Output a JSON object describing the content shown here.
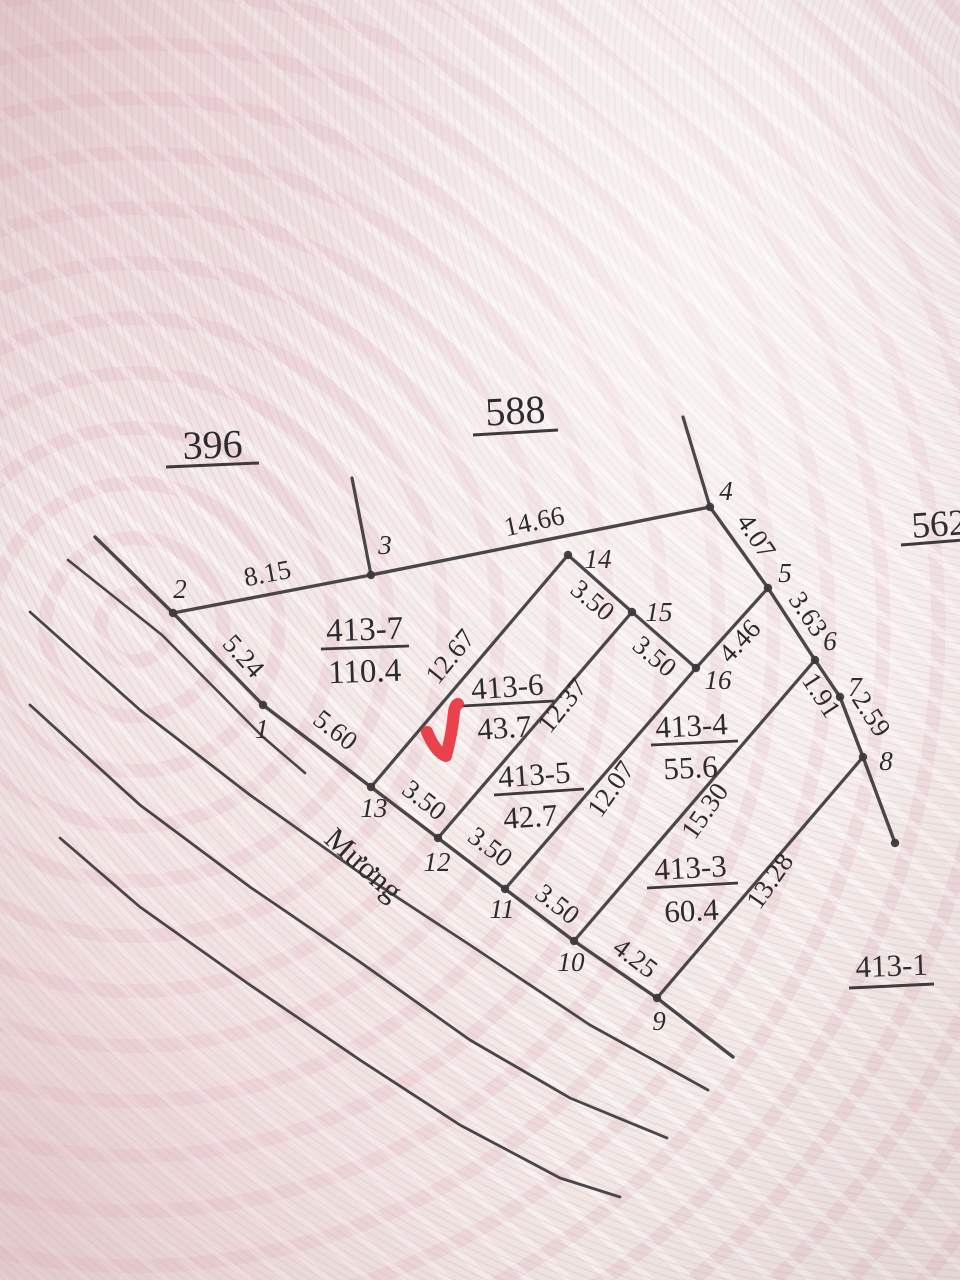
{
  "title": "Cadastral sketch photo - parcel 413 subdivision",
  "ink": "#3d393c",
  "text_color": "#2e2b2f",
  "accent_red": "#e8333e",
  "canal_label": {
    "text": "Mương",
    "x": 357,
    "y": 872,
    "rot": 42,
    "size": 31
  },
  "checkmark": {
    "path": "M 427 732 Q 436 753 446 756 Q 452 734 454 712 Q 455 705 458 704",
    "width": 12
  },
  "lines": [
    {
      "name": "south-boundary-canal-edge",
      "w": 3.4,
      "p": [
        [
          95,
          537
        ],
        [
          173,
          613
        ],
        [
          263,
          705
        ],
        [
          371,
          787
        ],
        [
          438,
          838
        ],
        [
          505,
          889
        ],
        [
          574,
          941
        ],
        [
          657,
          998
        ],
        [
          733,
          1057
        ]
      ]
    },
    {
      "name": "north-boundary",
      "w": 3.4,
      "p": [
        [
          173,
          613
        ],
        [
          371,
          575
        ],
        [
          710,
          507
        ]
      ]
    },
    {
      "name": "point3-extension",
      "w": 3.2,
      "p": [
        [
          352,
          478
        ],
        [
          371,
          575
        ]
      ]
    },
    {
      "name": "point4-extension",
      "w": 3.2,
      "p": [
        [
          683,
          417
        ],
        [
          710,
          507
        ]
      ]
    },
    {
      "name": "east-boundary",
      "w": 3.4,
      "p": [
        [
          710,
          507
        ],
        [
          768,
          588
        ],
        [
          815,
          660
        ],
        [
          840,
          697
        ],
        [
          863,
          757
        ],
        [
          895,
          843
        ]
      ]
    },
    {
      "name": "cross-line-14-15-16-5",
      "w": 3.2,
      "p": [
        [
          568,
          555
        ],
        [
          632,
          612
        ],
        [
          696,
          668
        ],
        [
          768,
          588
        ]
      ]
    },
    {
      "name": "strip-edge-14-13",
      "w": 3.2,
      "p": [
        [
          568,
          555
        ],
        [
          371,
          787
        ]
      ]
    },
    {
      "name": "strip-edge-15-12",
      "w": 3.2,
      "p": [
        [
          632,
          612
        ],
        [
          438,
          838
        ]
      ]
    },
    {
      "name": "strip-edge-16-11",
      "w": 3.2,
      "p": [
        [
          696,
          668
        ],
        [
          505,
          889
        ]
      ]
    },
    {
      "name": "strip-edge-6-10",
      "w": 3.2,
      "p": [
        [
          815,
          660
        ],
        [
          574,
          941
        ]
      ]
    },
    {
      "name": "strip-edge-8-9",
      "w": 3.2,
      "p": [
        [
          863,
          757
        ],
        [
          657,
          998
        ]
      ]
    },
    {
      "name": "parallel-line-short",
      "w": 2.6,
      "p": [
        [
          68,
          560
        ],
        [
          162,
          635
        ],
        [
          263,
          737
        ],
        [
          305,
          773
        ]
      ]
    },
    {
      "name": "canal-line-1",
      "w": 2.8,
      "p": [
        [
          30,
          612
        ],
        [
          140,
          710
        ],
        [
          250,
          795
        ],
        [
          360,
          873
        ],
        [
          470,
          945
        ],
        [
          590,
          1025
        ],
        [
          708,
          1090
        ]
      ]
    },
    {
      "name": "canal-line-2",
      "w": 2.8,
      "p": [
        [
          30,
          705
        ],
        [
          140,
          805
        ],
        [
          250,
          887
        ],
        [
          360,
          962
        ],
        [
          470,
          1040
        ],
        [
          570,
          1098
        ],
        [
          667,
          1138
        ]
      ]
    },
    {
      "name": "canal-line-3",
      "w": 2.8,
      "p": [
        [
          60,
          838
        ],
        [
          140,
          907
        ],
        [
          250,
          985
        ],
        [
          360,
          1060
        ],
        [
          460,
          1125
        ],
        [
          560,
          1178
        ],
        [
          620,
          1197
        ]
      ]
    }
  ],
  "vertices": [
    [
      173,
      613
    ],
    [
      371,
      575
    ],
    [
      710,
      507
    ],
    [
      768,
      588
    ],
    [
      815,
      660
    ],
    [
      840,
      697
    ],
    [
      863,
      757
    ],
    [
      263,
      705
    ],
    [
      371,
      787
    ],
    [
      438,
      838
    ],
    [
      505,
      889
    ],
    [
      574,
      941
    ],
    [
      657,
      998
    ],
    [
      568,
      555
    ],
    [
      632,
      612
    ],
    [
      696,
      668
    ],
    [
      895,
      843
    ]
  ],
  "region_labels": [
    {
      "text": "396",
      "x": 213,
      "y": 458,
      "rot": -2,
      "size": 40,
      "ul": [
        166,
        467,
        259,
        463
      ]
    },
    {
      "text": "588",
      "x": 516,
      "y": 424,
      "rot": -3,
      "size": 40,
      "ul": [
        473,
        435,
        558,
        430
      ]
    },
    {
      "text": "562",
      "x": 940,
      "y": 536,
      "rot": -4,
      "size": 37,
      "ul": [
        901,
        545,
        975,
        539
      ]
    },
    {
      "text": "413-1",
      "x": 892,
      "y": 976,
      "rot": -2,
      "size": 31,
      "ul": [
        849,
        988,
        934,
        984
      ]
    }
  ],
  "parcel_labels": [
    {
      "name": "413-7",
      "area": "110.4",
      "x": 365,
      "y": 640,
      "ax": 365,
      "ay": 682,
      "rot": -2,
      "size": 33,
      "ul": [
        321,
        649,
        409,
        646
      ]
    },
    {
      "name": "413-6",
      "area": "43.7",
      "x": 508,
      "y": 697,
      "ax": 505,
      "ay": 738,
      "rot": -4,
      "size": 31,
      "ul": [
        462,
        706,
        554,
        701
      ]
    },
    {
      "name": "413-5",
      "area": "42.7",
      "x": 535,
      "y": 785,
      "ax": 531,
      "ay": 827,
      "rot": -4,
      "size": 31,
      "ul": [
        494,
        795,
        584,
        789
      ]
    },
    {
      "name": "413-4",
      "area": "55.6",
      "x": 692,
      "y": 736,
      "ax": 691,
      "ay": 778,
      "rot": -3,
      "size": 31,
      "ul": [
        651,
        745,
        738,
        741
      ]
    },
    {
      "name": "413-3",
      "area": "60.4",
      "x": 691,
      "y": 878,
      "ax": 692,
      "ay": 921,
      "rot": -3,
      "size": 31,
      "ul": [
        647,
        888,
        738,
        883
      ]
    }
  ],
  "dim_labels": [
    {
      "text": "8.15",
      "x": 269,
      "y": 582,
      "rot": -11
    },
    {
      "text": "14.66",
      "x": 536,
      "y": 530,
      "rot": -12
    },
    {
      "text": "5.24",
      "x": 237,
      "y": 662,
      "rot": 48
    },
    {
      "text": "5.60",
      "x": 330,
      "y": 737,
      "rot": 38
    },
    {
      "text": "3.50",
      "x": 419,
      "y": 807,
      "rot": 38
    },
    {
      "text": "3.50",
      "x": 485,
      "y": 854,
      "rot": 37
    },
    {
      "text": "3.50",
      "x": 552,
      "y": 911,
      "rot": 38
    },
    {
      "text": "4.25",
      "x": 630,
      "y": 965,
      "rot": 37
    },
    {
      "text": "12.67",
      "x": 457,
      "y": 662,
      "rot": -51
    },
    {
      "text": "12.37",
      "x": 569,
      "y": 711,
      "rot": -51
    },
    {
      "text": "12.07",
      "x": 618,
      "y": 794,
      "rot": -55
    },
    {
      "text": "15.30",
      "x": 712,
      "y": 816,
      "rot": -55
    },
    {
      "text": "13.28",
      "x": 777,
      "y": 886,
      "rot": -55
    },
    {
      "text": "3.50",
      "x": 587,
      "y": 607,
      "rot": 40
    },
    {
      "text": "3.50",
      "x": 649,
      "y": 663,
      "rot": 40
    },
    {
      "text": "4.46",
      "x": 746,
      "y": 647,
      "rot": -47
    },
    {
      "text": "4.07",
      "x": 749,
      "y": 541,
      "rot": 56
    },
    {
      "text": "3.63",
      "x": 801,
      "y": 619,
      "rot": 56
    },
    {
      "text": "1.91",
      "x": 814,
      "y": 700,
      "rot": 57
    },
    {
      "text": "2.59",
      "x": 864,
      "y": 719,
      "rot": 57
    }
  ],
  "point_labels": [
    {
      "text": "1",
      "x": 262,
      "y": 738
    },
    {
      "text": "2",
      "x": 180,
      "y": 598
    },
    {
      "text": "3",
      "x": 385,
      "y": 554
    },
    {
      "text": "4",
      "x": 726,
      "y": 500
    },
    {
      "text": "5",
      "x": 785,
      "y": 582
    },
    {
      "text": "6",
      "x": 830,
      "y": 650
    },
    {
      "text": "7",
      "x": 855,
      "y": 696
    },
    {
      "text": "8",
      "x": 886,
      "y": 770
    },
    {
      "text": "9",
      "x": 659,
      "y": 1030
    },
    {
      "text": "10",
      "x": 571,
      "y": 971
    },
    {
      "text": "11",
      "x": 502,
      "y": 918
    },
    {
      "text": "12",
      "x": 437,
      "y": 871
    },
    {
      "text": "13",
      "x": 374,
      "y": 817
    },
    {
      "text": "14",
      "x": 598,
      "y": 568
    },
    {
      "text": "15",
      "x": 659,
      "y": 621
    },
    {
      "text": "16",
      "x": 718,
      "y": 689
    }
  ]
}
